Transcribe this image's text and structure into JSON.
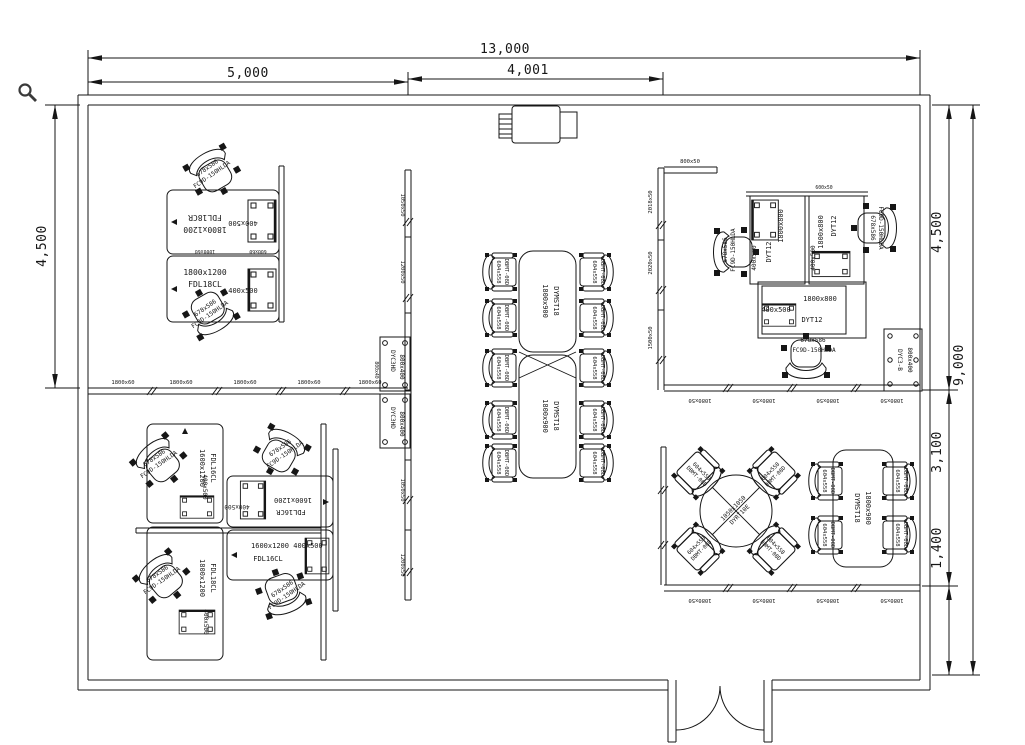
{
  "canvas": {
    "tool_cursor": "magnifier"
  },
  "dimensions": {
    "top_total": "13,000",
    "top_left": "5,000",
    "top_mid": "4,001",
    "left_height": "4,500",
    "right_top": "4,500",
    "right_mid": "3,100",
    "right_bottom": "1,400",
    "right_total": "9,000"
  },
  "desks": {
    "size_1800x1200": "1800x1200",
    "size_1600x1200": "1600x1200",
    "size_1800x800": "1800x800",
    "fdl18cr": "FDL18CR",
    "fdl18cl": "FDL18CL",
    "fdl16cl": "FDL16CL",
    "fdl16cr": "FDL16CR",
    "dyt12": "DYT12",
    "pedestal": "400x500"
  },
  "chairs": {
    "office_size": "678x586",
    "office_model": "FC9D-150HLDA",
    "conference_size": "604x558",
    "conference_model": "DBMT-08D"
  },
  "tables": {
    "conference_size": "1800x900",
    "conference_model": "DYMST18",
    "round_size": "1050x1050",
    "round_model": "DYRT10E"
  },
  "storage": {
    "dyc3hd_model": "DYC3HD",
    "dyc3hd_size": "800x400",
    "dyc3b_model": "DYC3-B",
    "dyc3b_size": "800x400"
  },
  "partitions": {
    "seg_1800x60": "1800x60",
    "seg_1080x50": "1080x50",
    "seg_800x50": "800x50",
    "seg_600x50": "600x50",
    "seg_2018x50": "2018x50",
    "seg_2020x50": "2020x50",
    "seg_1500x50": "1500x50",
    "seg_1050x50": "1050x50",
    "seg_1200x50": "1200x50",
    "seg_800x40": "800x40",
    "seg_1000x60": "1000x60",
    "seg_600x60": "600x60"
  }
}
